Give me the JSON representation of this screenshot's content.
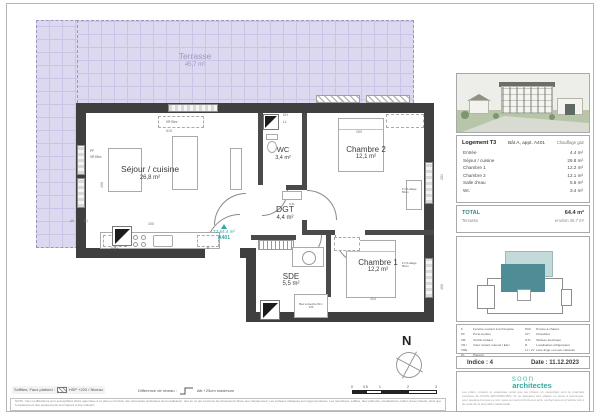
{
  "colors": {
    "teal": "#2fa9a2",
    "wall": "#3f3f3f",
    "terrace_fill": "#dbd8f0",
    "site_apartment": "#4e8d95",
    "site_terrace": "#c3d9da"
  },
  "plan": {
    "terrace": {
      "name": "Terrasse",
      "area": "45,7 m²"
    },
    "sejour": {
      "name": "Séjour / cuisine",
      "area": "26,8 m²"
    },
    "wc": {
      "name": "WC",
      "area": "3,4 m²"
    },
    "chambre2": {
      "name": "Chambre 2",
      "area": "12,1 m²"
    },
    "dgt": {
      "name": "DGT",
      "area": "4,4 m²"
    },
    "chambre1": {
      "name": "Chambre 1",
      "area": "12,2 m²"
    },
    "sde": {
      "name": "SDE",
      "area": "5,5 m²"
    },
    "marker": {
      "line1": "T3 64.4 m²",
      "line2": "A401"
    },
    "north": "N",
    "labels": {
      "vr_elec_top": "VR Elec",
      "pf_left": "PF",
      "vr_elec_left": "VR Elec",
      "ch": "CH",
      "ll": "LL",
      "gtl": "GTL",
      "lv_ll": "LV/LL",
      "refrigerateur": "R",
      "window_allege_1": "F h/b allège 50cm",
      "window_allege_2": "F h/b allège 50cm",
      "shower": "Bac à douche 90 x 120"
    },
    "dims": {
      "top": "815",
      "kitchen": "305",
      "d40": "40",
      "d51": "51",
      "sejour_left": "408",
      "chambre2_top": "269",
      "chambre1_bottom": "304",
      "right_upper": "281",
      "right_lower": "400"
    }
  },
  "panel": {
    "unit": {
      "title": "Logement T3",
      "location": "Bât A, appt. A401",
      "heating": "Chauffage gaz"
    },
    "rooms": [
      {
        "label": "Entrée",
        "area": "4.4 m²"
      },
      {
        "label": "Séjour / cuisine",
        "area": "26.8 m²"
      },
      {
        "label": "Chambre 1",
        "area": "12.2 m²"
      },
      {
        "label": "Chambre 2",
        "area": "12.1 m²"
      },
      {
        "label": "Salle d'eau",
        "area": "5.5 m²"
      },
      {
        "label": "Wc",
        "area": "3.4 m²"
      }
    ],
    "total": {
      "label": "TOTAL",
      "value": "64.4 m²",
      "terrace_label": "Terrasse",
      "terrace_value": "environ 45.7 m²"
    },
    "legend_left": [
      {
        "abbr": "F",
        "label": "Fenêtre ouvrant à la française"
      },
      {
        "abbr": "PF",
        "label": "Porte-fenêtre"
      },
      {
        "abbr": "OB",
        "label": "Oscillo-battant"
      },
      {
        "abbr": "VR / VRE",
        "label": "Volet roulant manuel / Elec"
      },
      {
        "abbr": "PL",
        "label": "Placard"
      }
    ],
    "legend_right": [
      {
        "abbr": "PAC",
        "label": "Pompe à chaleur"
      },
      {
        "abbr": "CH",
        "label": "Chaudière"
      },
      {
        "abbr": "GTL",
        "label": "Tableau électrique"
      },
      {
        "abbr": "R",
        "label": "Localisation réfrigérateur"
      },
      {
        "abbr": "LL / LV",
        "label": "Lave-linge ou Lave-vaisselle"
      }
    ],
    "indice": "Indice : 4",
    "date": "Date : 11.12.2023",
    "logo": {
      "line1": "soon",
      "line2": "architectes"
    },
    "legal": "Les plans, croquis et esquisses, ainsi que les photos s'y rapportant sont la propriété exclusive de SOON ARCHITECTES. Ils ne sauraient être utilisés ou remis à quiconque, pour quelque but que ce soit, sans son accord formel et écrit, conformément à l'article 111-1 du code de la propriété intellectuelle."
  },
  "footer": {
    "soffites_label": "Soffites, Faux plafond :",
    "soffites_value": "HSP +220 / Niveau",
    "niveau_label": "Différence de niveau :",
    "niveau_value": "Alti +25cm maximum",
    "nota": "NOTA : Des modifications sont susceptibles d'être apportées à ce plan en fonction des nécessités techniques de la réalisation, tant en ce qui concerne les dimensions libres que l'équipement. Les surfaces indiquées sont approximatives. Les retombées, soffites, faux plafonds, canalisations, ballon d'eau chaude, ainsi que l'emplacement des équipements sont figurés à titre indicatif.",
    "scale": [
      "0",
      "0.5",
      "1",
      "2",
      "3"
    ]
  }
}
